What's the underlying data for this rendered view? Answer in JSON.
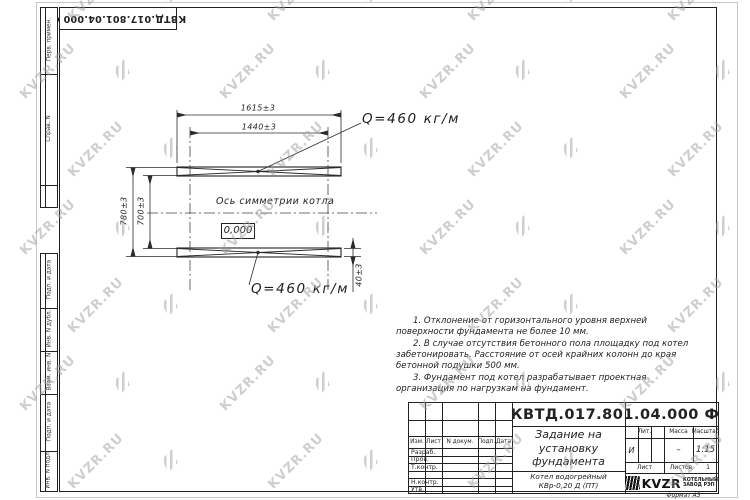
{
  "watermark": {
    "text": "KVZR.RU"
  },
  "stamp_top": {
    "text": "КВТД.017.801.04.000 Ф"
  },
  "frame_left": {
    "top_cells": [
      "Перв. примен.",
      "Справ. N",
      ""
    ],
    "bottom_cells": [
      "Подп. и дата",
      "Инв. N дубл.",
      "Взам. инв. N",
      "Подп. и дата",
      "Инв. N подл."
    ]
  },
  "drawing": {
    "dim_width_outer": "1615±3",
    "dim_width_inner": "1440±3",
    "dim_height_outer": "780±3",
    "dim_height_inner": "700±3",
    "dim_offset": "40±3",
    "load_top": "Q=460 кг/м",
    "load_bottom": "Q=460 кг/м",
    "axis_label": "Ось симметрии котла",
    "elevation": "0,000"
  },
  "notes": {
    "items": [
      "1. Отклонение от горизонтального уровня верхней поверхности фундамента не более 10 мм.",
      "2. В случае отсутствия бетонного пола площадку под котел забетонировать. Расстояние от осей крайних колонн до края бетонной подушки 500 мм.",
      "3. Фундамент под котел разрабатывает проектная организация по нагрузкам на фундамент."
    ]
  },
  "title_block": {
    "doc_number": "КВТД.017.801.04.000 Ф",
    "title_lines": [
      "Задание на",
      "установку",
      "фундамента"
    ],
    "product_lines": [
      "Котел водогрейный",
      "КВр-0,20 Д (ПТ)"
    ],
    "header_cols": [
      "Изм.",
      "Лист",
      "N докум.",
      "Подп.",
      "Дата"
    ],
    "rows": [
      "Разраб.",
      "Пров.",
      "Т.контр.",
      "",
      "Н.контр.",
      "Утв."
    ],
    "lit_label": "Лит.",
    "lit_value": "И",
    "mass_label": "Масса",
    "mass_value": "–",
    "scale_label": "Масштаб",
    "scale_value": "1:15",
    "sheet_label": "Лист",
    "sheets_label": "Листов",
    "sheets_value": "1",
    "company": {
      "logo_text": "KVZR",
      "name_lines": [
        "КОТЕЛЬНЫЙ",
        "ЗАВОД РЭП"
      ]
    },
    "format": "Формат А3"
  }
}
